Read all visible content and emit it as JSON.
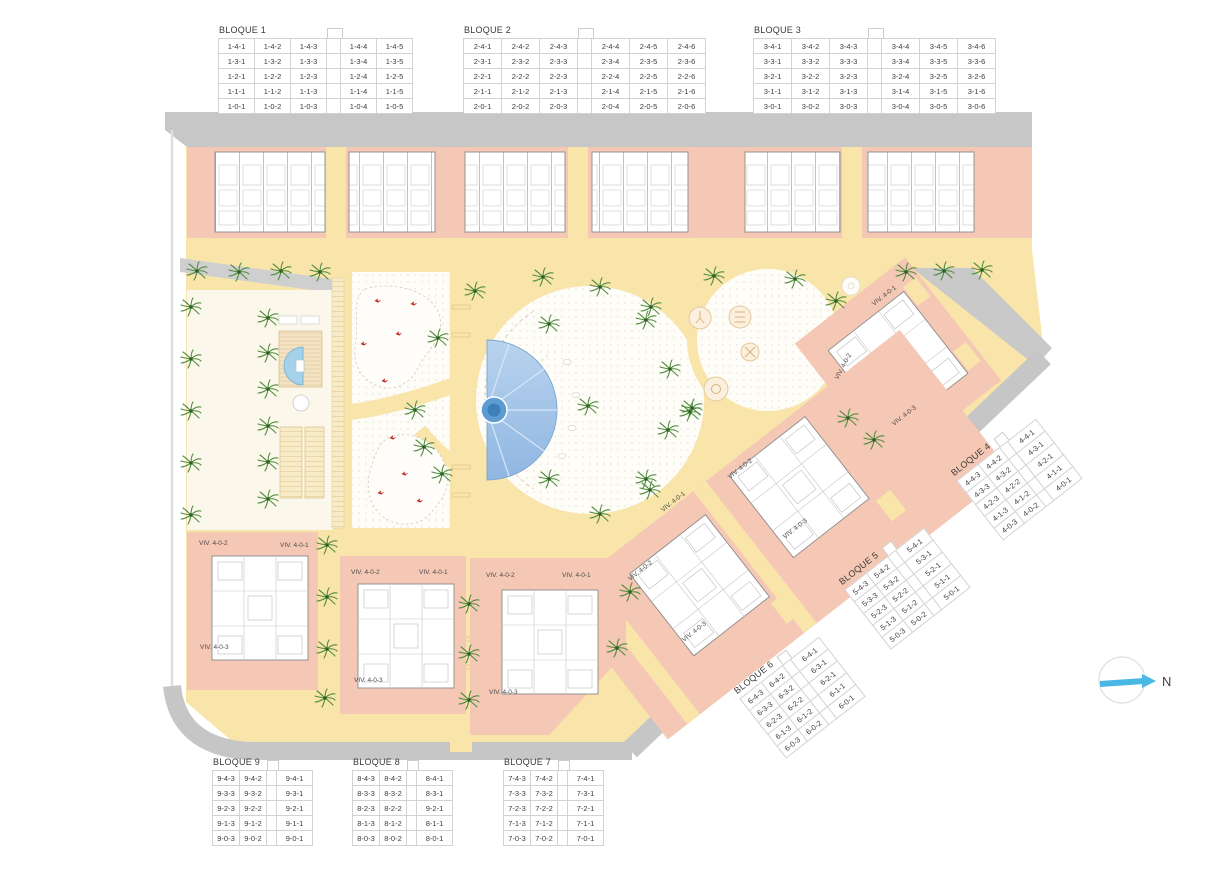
{
  "compass": {
    "label": "N"
  },
  "colors": {
    "plot_salmon": "#f5c7b5",
    "path_yellow": "#f9e4aa",
    "road_gray": "#c7c7c7",
    "cream": "#fbf7ea",
    "pool_blue": "#9fc3e6",
    "palm_green": "#4e8c3c",
    "red_marker": "#bf2b22",
    "compass_blue": "#49b8e5"
  },
  "tables": {
    "b1": {
      "title": "BLOQUE 1",
      "rows": [
        [
          "1-4-1",
          "1-4-2",
          "1-4-3",
          "1-4-4",
          "1-4-5"
        ],
        [
          "1-3-1",
          "1-3-2",
          "1-3-3",
          "1-3-4",
          "1-3-5"
        ],
        [
          "1-2-1",
          "1-2-2",
          "1-2-3",
          "1-2-4",
          "1-2-5"
        ],
        [
          "1-1-1",
          "1-1-2",
          "1-1-3",
          "1-1-4",
          "1-1-5"
        ],
        [
          "1-0-1",
          "1-0-2",
          "1-0-3",
          "1-0-4",
          "1-0-5"
        ]
      ]
    },
    "b2": {
      "title": "BLOQUE 2",
      "rows": [
        [
          "2-4-1",
          "2-4-2",
          "2-4-3",
          "2-4-4",
          "2-4-5",
          "2-4-6"
        ],
        [
          "2-3-1",
          "2-3-2",
          "2-3-3",
          "2-3-4",
          "2-3-5",
          "2-3-6"
        ],
        [
          "2-2-1",
          "2-2-2",
          "2-2-3",
          "2-2-4",
          "2-2-5",
          "2-2-6"
        ],
        [
          "2-1-1",
          "2-1-2",
          "2-1-3",
          "2-1-4",
          "2-1-5",
          "2-1-6"
        ],
        [
          "2-0-1",
          "2-0-2",
          "2-0-3",
          "2-0-4",
          "2-0-5",
          "2-0-6"
        ]
      ]
    },
    "b3": {
      "title": "BLOQUE 3",
      "rows": [
        [
          "3-4-1",
          "3-4-2",
          "3-4-3",
          "3-4-4",
          "3-4-5",
          "3-4-6"
        ],
        [
          "3-3-1",
          "3-3-2",
          "3-3-3",
          "3-3-4",
          "3-3-5",
          "3-3-6"
        ],
        [
          "3-2-1",
          "3-2-2",
          "3-2-3",
          "3-2-4",
          "3-2-5",
          "3-2-6"
        ],
        [
          "3-1-1",
          "3-1-2",
          "3-1-3",
          "3-1-4",
          "3-1-5",
          "3-1-6"
        ],
        [
          "3-0-1",
          "3-0-2",
          "3-0-3",
          "3-0-4",
          "3-0-5",
          "3-0-6"
        ]
      ]
    },
    "b4": {
      "title": "BLOQUE 4",
      "rows": [
        [
          "4-4-3",
          "4-4-2",
          "4-4-1"
        ],
        [
          "4-3-3",
          "4-3-2",
          "4-3-1"
        ],
        [
          "4-2-3",
          "4-2-2",
          "4-2-1"
        ],
        [
          "4-1-3",
          "4-1-2",
          "4-1-1"
        ],
        [
          "4-0-3",
          "4-0-2",
          "4-0-1"
        ]
      ]
    },
    "b5": {
      "title": "BLOQUE 5",
      "rows": [
        [
          "5-4-3",
          "5-4-2",
          "5-4-1"
        ],
        [
          "5-3-3",
          "5-3-2",
          "5-3-1"
        ],
        [
          "5-2-3",
          "5-2-2",
          "5-2-1"
        ],
        [
          "5-1-3",
          "5-1-2",
          "5-1-1"
        ],
        [
          "5-0-3",
          "5-0-2",
          "5-0-1"
        ]
      ]
    },
    "b6": {
      "title": "BLOQUE 6",
      "rows": [
        [
          "6-4-3",
          "6-4-2",
          "6-4-1"
        ],
        [
          "6-3-3",
          "6-3-2",
          "6-3-1"
        ],
        [
          "6-2-3",
          "6-2-2",
          "6-2-1"
        ],
        [
          "6-1-3",
          "6-1-2",
          "6-1-1"
        ],
        [
          "6-0-3",
          "6-0-2",
          "6-0-1"
        ]
      ]
    },
    "b7": {
      "title": "BLOQUE 7",
      "rows": [
        [
          "7-4-3",
          "7-4-2",
          "7-4-1"
        ],
        [
          "7-3-3",
          "7-3-2",
          "7-3-1"
        ],
        [
          "7-2-3",
          "7-2-2",
          "7-2-1"
        ],
        [
          "7-1-3",
          "7-1-2",
          "7-1-1"
        ],
        [
          "7-0-3",
          "7-0-2",
          "7-0-1"
        ]
      ]
    },
    "b8": {
      "title": "BLOQUE 8",
      "rows": [
        [
          "8-4-3",
          "8-4-2",
          "8-4-1"
        ],
        [
          "8-3-3",
          "8-3-2",
          "8-3-1"
        ],
        [
          "8-2-3",
          "8-2-2",
          "9-2-1"
        ],
        [
          "8-1-3",
          "8-1-2",
          "8-1-1"
        ],
        [
          "8-0-3",
          "8-0-2",
          "8-0-1"
        ]
      ]
    },
    "b9": {
      "title": "BLOQUE 9",
      "rows": [
        [
          "9-4-3",
          "9-4-2",
          "9-4-1"
        ],
        [
          "9-3-3",
          "9-3-2",
          "9-3-1"
        ],
        [
          "9-2-3",
          "9-2-2",
          "9-2-1"
        ],
        [
          "9-1-3",
          "9-1-2",
          "9-1-1"
        ],
        [
          "9-0-3",
          "9-0-2",
          "9-0-1"
        ]
      ]
    }
  },
  "viv_labels": [
    "VIV. 4-0-1",
    "VIV. 4-0-2",
    "VIV. 4-0-3",
    "VIV. 4-0-2",
    "VIV. 4-0-3",
    "VIV. 4-0-1",
    "VIV. 4-0-2",
    "VIV. 4-0-3",
    "VIV. 4-0-2",
    "VIV. 4-0-1",
    "VIV. 4-0-3",
    "VIV. 4-0-2",
    "VIV. 4-0-1",
    "VIV. 4-0-3",
    "VIV. 4-0-2",
    "VIV. 4-0-1",
    "VIV. 4-0-3"
  ]
}
